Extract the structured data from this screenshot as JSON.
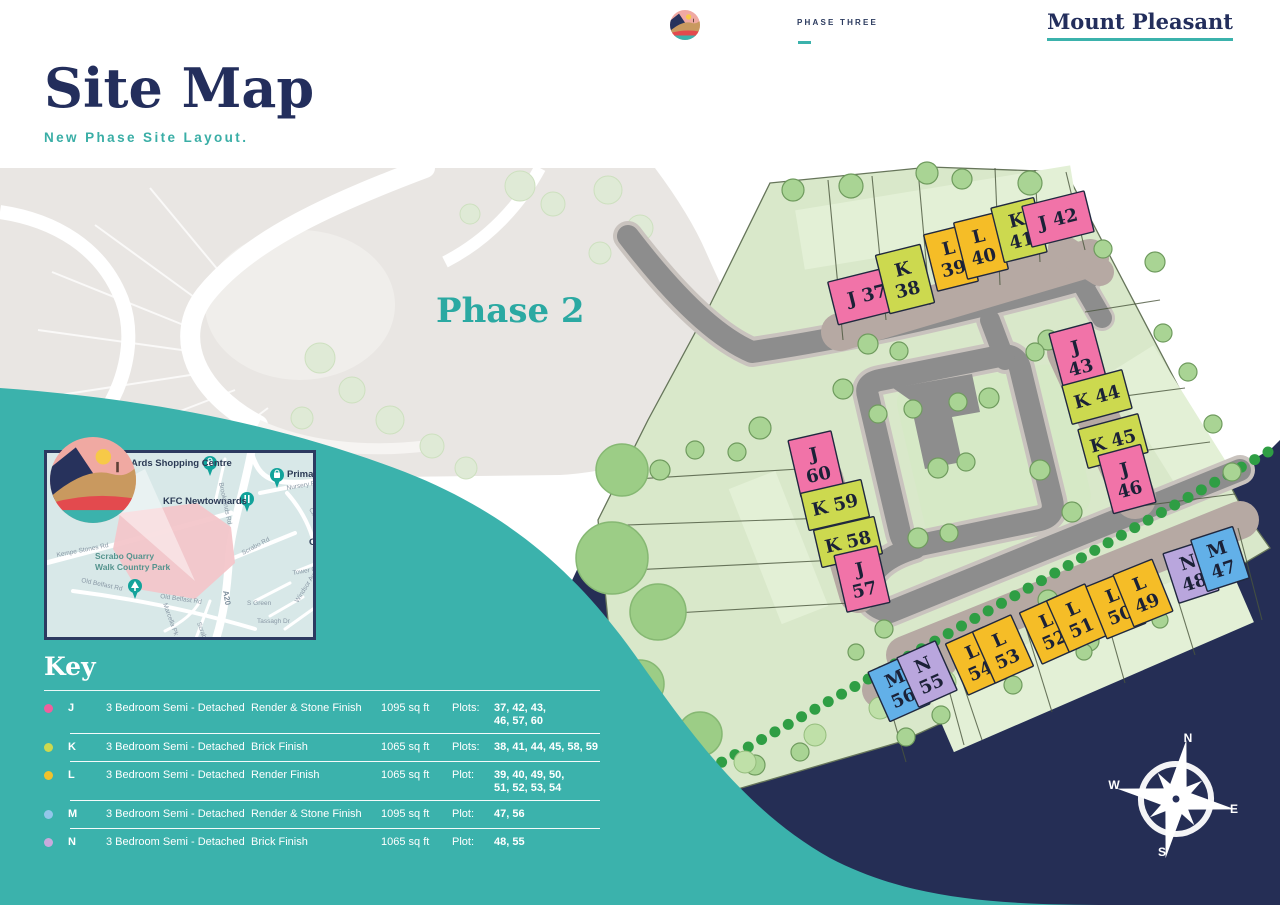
{
  "header": {
    "phase_label": "PHASE THREE",
    "brand": "Mount Pleasant"
  },
  "title": {
    "heading": "Site Map",
    "subtitle": "New Phase Site Layout."
  },
  "colors": {
    "accent_teal": "#3bb2ac",
    "navy": "#232e5c",
    "wave_teal": "#3bb2ac",
    "water_navy": "#252e55",
    "site_green": "#d9e8ca",
    "road_grey": "#8d8d8d"
  },
  "map": {
    "phase2_label": "Phase 2",
    "compass": {
      "n": "N",
      "e": "E",
      "s": "S",
      "w": "W"
    },
    "type_colors": {
      "J": "#f173a8",
      "K": "#ccd94f",
      "L": "#f5bd27",
      "M": "#62b0e8",
      "N": "#b9a6dd"
    },
    "plots": [
      {
        "type": "J",
        "num": "37",
        "x": 867,
        "y": 295,
        "w": 70,
        "h": 44,
        "a": -14,
        "stack": 0
      },
      {
        "type": "K",
        "num": "38",
        "x": 905,
        "y": 279,
        "w": 46,
        "h": 60,
        "a": -14,
        "stack": 1
      },
      {
        "type": "L",
        "num": "39",
        "x": 951,
        "y": 258,
        "w": 42,
        "h": 58,
        "a": -14,
        "stack": 1
      },
      {
        "type": "L",
        "num": "40",
        "x": 981,
        "y": 246,
        "w": 42,
        "h": 58,
        "a": -14,
        "stack": 1
      },
      {
        "type": "K",
        "num": "41",
        "x": 1019,
        "y": 230,
        "w": 44,
        "h": 56,
        "a": -14,
        "stack": 1
      },
      {
        "type": "J",
        "num": "42",
        "x": 1058,
        "y": 219,
        "w": 64,
        "h": 42,
        "a": -14,
        "stack": 0
      },
      {
        "type": "J",
        "num": "43",
        "x": 1078,
        "y": 357,
        "w": 44,
        "h": 60,
        "a": -15,
        "stack": 1
      },
      {
        "type": "K",
        "num": "44",
        "x": 1097,
        "y": 397,
        "w": 62,
        "h": 40,
        "a": -15,
        "stack": 0
      },
      {
        "type": "K",
        "num": "45",
        "x": 1113,
        "y": 441,
        "w": 62,
        "h": 40,
        "a": -15,
        "stack": 0
      },
      {
        "type": "J",
        "num": "46",
        "x": 1127,
        "y": 479,
        "w": 44,
        "h": 60,
        "a": -15,
        "stack": 1
      },
      {
        "type": "J",
        "num": "60",
        "x": 816,
        "y": 464,
        "w": 44,
        "h": 58,
        "a": -13,
        "stack": 1
      },
      {
        "type": "K",
        "num": "59",
        "x": 835,
        "y": 505,
        "w": 62,
        "h": 38,
        "a": -13,
        "stack": 0
      },
      {
        "type": "K",
        "num": "58",
        "x": 848,
        "y": 542,
        "w": 62,
        "h": 38,
        "a": -13,
        "stack": 0
      },
      {
        "type": "J",
        "num": "57",
        "x": 862,
        "y": 579,
        "w": 44,
        "h": 58,
        "a": -13,
        "stack": 1
      },
      {
        "type": "M",
        "num": "56",
        "x": 899,
        "y": 688,
        "w": 44,
        "h": 54,
        "a": -24,
        "stack": 1
      },
      {
        "type": "N",
        "num": "55",
        "x": 927,
        "y": 674,
        "w": 42,
        "h": 54,
        "a": -24,
        "stack": 1
      },
      {
        "type": "L",
        "num": "54",
        "x": 976,
        "y": 661,
        "w": 42,
        "h": 56,
        "a": -24,
        "stack": 1
      },
      {
        "type": "L",
        "num": "53",
        "x": 1003,
        "y": 649,
        "w": 42,
        "h": 56,
        "a": -24,
        "stack": 1
      },
      {
        "type": "L",
        "num": "52",
        "x": 1050,
        "y": 630,
        "w": 42,
        "h": 56,
        "a": -24,
        "stack": 1
      },
      {
        "type": "L",
        "num": "51",
        "x": 1077,
        "y": 618,
        "w": 42,
        "h": 56,
        "a": -24,
        "stack": 1
      },
      {
        "type": "L",
        "num": "50",
        "x": 1116,
        "y": 605,
        "w": 42,
        "h": 56,
        "a": -22,
        "stack": 1
      },
      {
        "type": "L",
        "num": "49",
        "x": 1143,
        "y": 593,
        "w": 42,
        "h": 56,
        "a": -22,
        "stack": 1
      },
      {
        "type": "N",
        "num": "48",
        "x": 1191,
        "y": 572,
        "w": 42,
        "h": 52,
        "a": -18,
        "stack": 1
      },
      {
        "type": "M",
        "num": "47",
        "x": 1220,
        "y": 559,
        "w": 44,
        "h": 54,
        "a": -18,
        "stack": 1
      }
    ]
  },
  "inset": {
    "labels": [
      {
        "text": "Ards Shopping Centre",
        "x": 84,
        "y": 13,
        "r": 0,
        "c": "poi"
      },
      {
        "text": "Primark",
        "x": 240,
        "y": 24,
        "r": 0,
        "c": "poi"
      },
      {
        "text": "KFC Newtownards",
        "x": 116,
        "y": 51,
        "r": 0,
        "c": "poi"
      },
      {
        "text": "Nursery Rd",
        "x": 240,
        "y": 37,
        "r": -10,
        "c": "road"
      },
      {
        "text": "Brooklands Rd",
        "x": 172,
        "y": 30,
        "r": 78,
        "c": "road"
      },
      {
        "text": "Circular Rd",
        "x": 262,
        "y": 56,
        "r": 65,
        "c": "road"
      },
      {
        "text": "Kempe Stones Rd",
        "x": 10,
        "y": 104,
        "r": -11,
        "c": "road"
      },
      {
        "text": "Scrabo Quarry",
        "x": 48,
        "y": 106,
        "r": 0,
        "c": "park"
      },
      {
        "text": "Walk Country Park",
        "x": 48,
        "y": 117,
        "r": 0,
        "c": "park"
      },
      {
        "text": "Old Belfast Rd",
        "x": 34,
        "y": 129,
        "r": 12,
        "c": "road"
      },
      {
        "text": "Old Belfast Rd",
        "x": 113,
        "y": 145,
        "r": 8,
        "c": "road"
      },
      {
        "text": "Scrabo Rd",
        "x": 196,
        "y": 102,
        "r": -28,
        "c": "road"
      },
      {
        "text": "Scrabo Rd",
        "x": 150,
        "y": 170,
        "r": 70,
        "c": "road"
      },
      {
        "text": "A20",
        "x": 176,
        "y": 138,
        "r": 80,
        "c": "roadbig"
      },
      {
        "text": "Marcella Pk",
        "x": 116,
        "y": 151,
        "r": 70,
        "c": "road"
      },
      {
        "text": "S Green",
        "x": 200,
        "y": 152,
        "r": 0,
        "c": "road"
      },
      {
        "text": "Tassagh Dr",
        "x": 210,
        "y": 170,
        "r": 0,
        "c": "road"
      },
      {
        "text": "Windsor Ave",
        "x": 251,
        "y": 150,
        "r": -58,
        "c": "road"
      },
      {
        "text": "Tower Ct",
        "x": 246,
        "y": 122,
        "r": -10,
        "c": "road"
      },
      {
        "text": "Gra",
        "x": 262,
        "y": 92,
        "r": 0,
        "c": "poi"
      }
    ]
  },
  "key": {
    "heading": "Key",
    "rows": [
      {
        "letter": "J",
        "dot": "#ef5f9d",
        "desc": "3 Bedroom Semi - Detached",
        "finish": "Render & Stone Finish",
        "size": "1095 sq ft",
        "plots_label": "Plots:",
        "plots": "37, 42, 43,\n46, 57, 60"
      },
      {
        "letter": "K",
        "dot": "#ccd94f",
        "desc": "3 Bedroom Semi - Detached",
        "finish": "Brick Finish",
        "size": "1065 sq ft",
        "plots_label": "Plots:",
        "plots": "38, 41, 44, 45, 58, 59"
      },
      {
        "letter": "L",
        "dot": "#f0c22c",
        "desc": "3 Bedroom Semi - Detached",
        "finish": "Render Finish",
        "size": "1065 sq ft",
        "plots_label": "Plot:",
        "plots": "39, 40, 49, 50,\n51, 52, 53, 54"
      },
      {
        "letter": "M",
        "dot": "#93c6ea",
        "desc": "3 Bedroom Semi - Detached",
        "finish": "Render & Stone Finish",
        "size": "1095 sq ft",
        "plots_label": "Plot:",
        "plots": "47, 56"
      },
      {
        "letter": "N",
        "dot": "#c9aadd",
        "desc": "3 Bedroom Semi - Detached",
        "finish": "Brick Finish",
        "size": "1065 sq ft",
        "plots_label": "Plot:",
        "plots": "48, 55"
      }
    ]
  }
}
